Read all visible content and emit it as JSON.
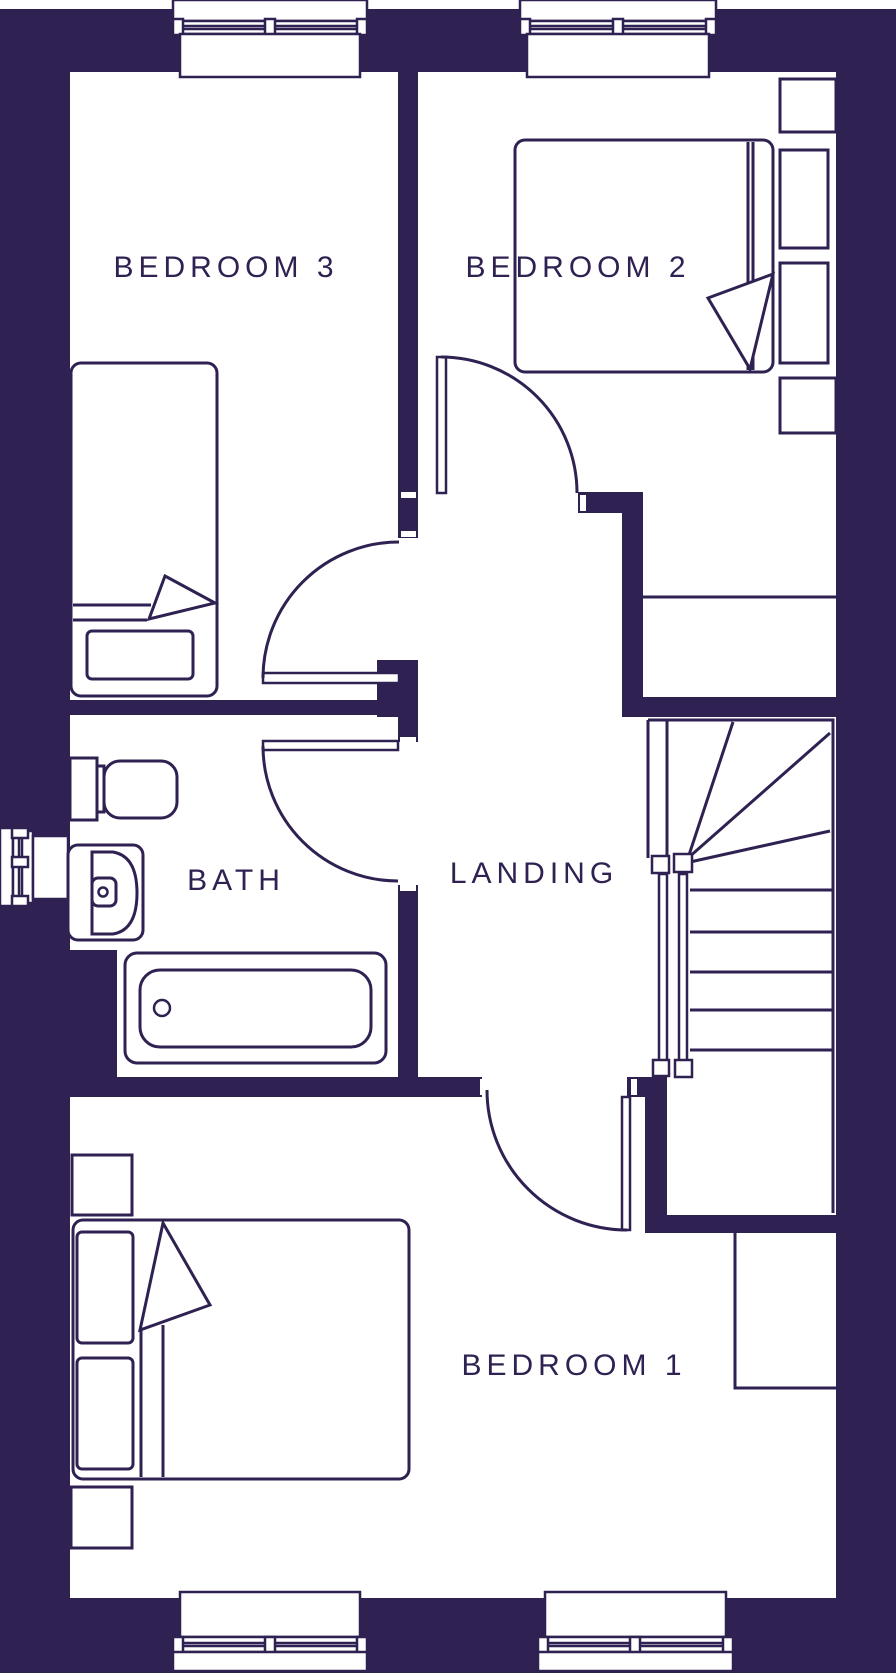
{
  "plan": {
    "type": "floor-plan",
    "rooms": {
      "bedroom3": {
        "label": "BEDROOM 3"
      },
      "bedroom2": {
        "label": "BEDROOM 2"
      },
      "bath": {
        "label": "BATH"
      },
      "landing": {
        "label": "LANDING"
      },
      "bedroom1": {
        "label": "BEDROOM 1"
      }
    },
    "fixtures": [
      "single-bed",
      "double-bed",
      "double-bed",
      "toilet",
      "basin",
      "bathtub",
      "staircase",
      "wardrobes",
      "windows",
      "doors"
    ],
    "colors": {
      "wall": "#2f2151",
      "floor": "#ffffff"
    }
  }
}
